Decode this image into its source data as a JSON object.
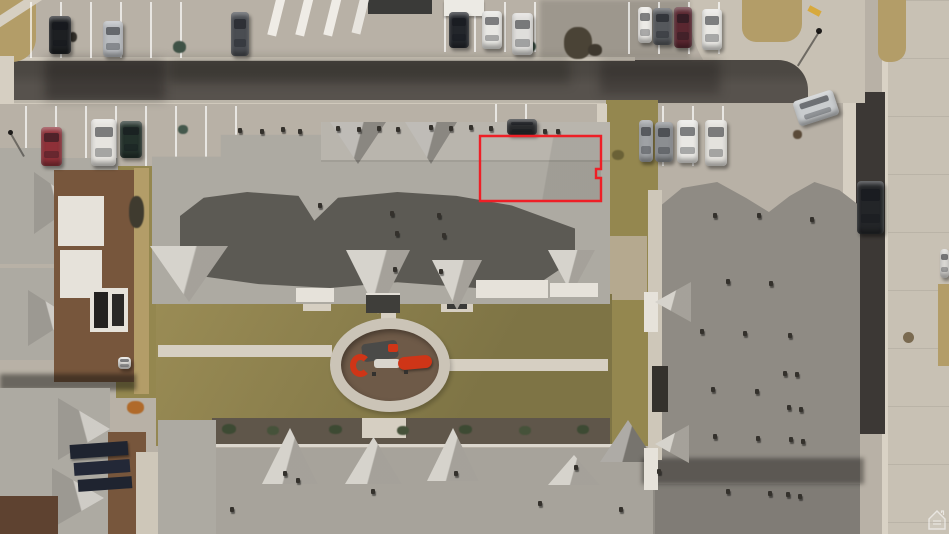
{
  "colors": {
    "concrete": "#b8b1a6",
    "concrete-light": "#cfc8bc",
    "sidewalk": "#d6cfc2",
    "asphalt": "#57524d",
    "asphalt-dark": "#3c3835",
    "road-concrete": "#c8c1b4",
    "roof-light": "#adaaa2",
    "roof-pale": "#bcb8b0",
    "roof-dark": "#5c5a54",
    "roof-mid": "#8f8b84",
    "roof-bottom": "#a7a39b",
    "dormer": "#c6c2b9",
    "grass": "#94874f",
    "grass-dry": "#b39d68",
    "mulch": "#6e5a48",
    "ring": "#cbc4b7",
    "play-red": "#cf3517",
    "outline-red": "#ee1f26",
    "wall-white": "#e6e2da",
    "wall-brown": "#77563c",
    "wall-tan": "#cec7b9",
    "curb-yellow": "#d7a93c"
  },
  "annotation": {
    "outline_points": "480,136 601,136 601,169 596,169 596,178 601,178 601,201 480,201",
    "outline_color": "#ee1f26"
  },
  "watermark": {
    "icon": "house-icon"
  },
  "cars": [
    {
      "x": 49,
      "y": 16,
      "w": 22,
      "h": 38,
      "color": "#1d1f22"
    },
    {
      "x": 103,
      "y": 21,
      "w": 20,
      "h": 36,
      "color": "#b9bcc0"
    },
    {
      "x": 231,
      "y": 12,
      "w": 18,
      "h": 44,
      "color": "#4a4d52"
    },
    {
      "x": 449,
      "y": 12,
      "w": 20,
      "h": 36,
      "color": "#23262b"
    },
    {
      "x": 482,
      "y": 11,
      "w": 20,
      "h": 38,
      "color": "#e8e7e3"
    },
    {
      "x": 512,
      "y": 13,
      "w": 21,
      "h": 42,
      "color": "#dfdedb"
    },
    {
      "x": 638,
      "y": 7,
      "w": 14,
      "h": 36,
      "color": "#eceae6"
    },
    {
      "x": 653,
      "y": 8,
      "w": 19,
      "h": 37,
      "color": "#55585c"
    },
    {
      "x": 674,
      "y": 7,
      "w": 18,
      "h": 41,
      "color": "#5a2730"
    },
    {
      "x": 702,
      "y": 9,
      "w": 20,
      "h": 41,
      "color": "#e9e8e4"
    },
    {
      "x": 795,
      "y": 95,
      "w": 42,
      "h": 26,
      "color": "#c9ccce",
      "rot": -18
    },
    {
      "x": 41,
      "y": 127,
      "w": 21,
      "h": 39,
      "color": "#8e3038"
    },
    {
      "x": 91,
      "y": 119,
      "w": 25,
      "h": 47,
      "color": "#e6e4df"
    },
    {
      "x": 120,
      "y": 121,
      "w": 22,
      "h": 37,
      "color": "#23312b"
    },
    {
      "x": 507,
      "y": 119,
      "w": 30,
      "h": 16,
      "color": "#2a2c2e"
    },
    {
      "x": 639,
      "y": 120,
      "w": 14,
      "h": 42,
      "color": "#9fa2a5"
    },
    {
      "x": 655,
      "y": 122,
      "w": 18,
      "h": 40,
      "color": "#8b8e91"
    },
    {
      "x": 677,
      "y": 120,
      "w": 21,
      "h": 43,
      "color": "#e9e8e4"
    },
    {
      "x": 705,
      "y": 120,
      "w": 22,
      "h": 46,
      "color": "#e4e2dd"
    },
    {
      "x": 857,
      "y": 181,
      "w": 27,
      "h": 53,
      "color": "#232528"
    },
    {
      "x": 940,
      "y": 249,
      "w": 9,
      "h": 29,
      "color": "#dcdad6"
    },
    {
      "x": 118,
      "y": 357,
      "w": 13,
      "h": 12,
      "color": "#e5e3df"
    }
  ],
  "vents": [
    [
      238,
      128
    ],
    [
      260,
      129
    ],
    [
      281,
      127
    ],
    [
      298,
      129
    ],
    [
      336,
      126
    ],
    [
      357,
      127
    ],
    [
      377,
      126
    ],
    [
      396,
      127
    ],
    [
      429,
      125
    ],
    [
      449,
      126
    ],
    [
      469,
      125
    ],
    [
      489,
      126
    ],
    [
      543,
      129
    ],
    [
      556,
      129
    ],
    [
      318,
      203
    ],
    [
      390,
      211
    ],
    [
      437,
      213
    ],
    [
      395,
      231
    ],
    [
      442,
      233
    ],
    [
      393,
      267
    ],
    [
      439,
      269
    ],
    [
      713,
      213
    ],
    [
      757,
      213
    ],
    [
      810,
      217
    ],
    [
      726,
      279
    ],
    [
      769,
      281
    ],
    [
      700,
      329
    ],
    [
      743,
      331
    ],
    [
      788,
      333
    ],
    [
      711,
      387
    ],
    [
      755,
      389
    ],
    [
      713,
      434
    ],
    [
      756,
      436
    ],
    [
      726,
      489
    ],
    [
      768,
      491
    ],
    [
      283,
      471
    ],
    [
      296,
      478
    ],
    [
      371,
      489
    ],
    [
      454,
      471
    ],
    [
      538,
      501
    ],
    [
      574,
      465
    ],
    [
      230,
      507
    ],
    [
      619,
      507
    ],
    [
      657,
      469
    ],
    [
      783,
      371
    ],
    [
      795,
      372
    ],
    [
      787,
      405
    ],
    [
      799,
      407
    ],
    [
      789,
      437
    ],
    [
      801,
      439
    ],
    [
      786,
      492
    ],
    [
      798,
      494
    ]
  ],
  "shrubs": [
    [
      564,
      27,
      28,
      32,
      "#4a4336"
    ],
    [
      588,
      44,
      14,
      12,
      "#3e382e"
    ],
    [
      129,
      196,
      15,
      32,
      "#3f3b2f"
    ],
    [
      127,
      401,
      17,
      13,
      "#b06a2a"
    ],
    [
      222,
      424,
      14,
      10,
      "#3d4a33"
    ],
    [
      267,
      426,
      12,
      9,
      "#46523a"
    ],
    [
      329,
      425,
      13,
      9,
      "#3d4a33"
    ],
    [
      397,
      426,
      12,
      9,
      "#46523a"
    ],
    [
      459,
      425,
      13,
      9,
      "#3d4a33"
    ],
    [
      519,
      426,
      12,
      9,
      "#46523a"
    ],
    [
      577,
      425,
      12,
      9,
      "#3d4a33"
    ],
    [
      69,
      32,
      8,
      10,
      "#35322c"
    ],
    [
      173,
      41,
      13,
      12,
      "#3f5246"
    ],
    [
      178,
      125,
      10,
      9,
      "#44584c"
    ],
    [
      523,
      41,
      13,
      11,
      "#3b4f43"
    ],
    [
      793,
      130,
      9,
      9,
      "#5a4a38"
    ],
    [
      612,
      150,
      12,
      10,
      "#6a6136"
    ]
  ]
}
